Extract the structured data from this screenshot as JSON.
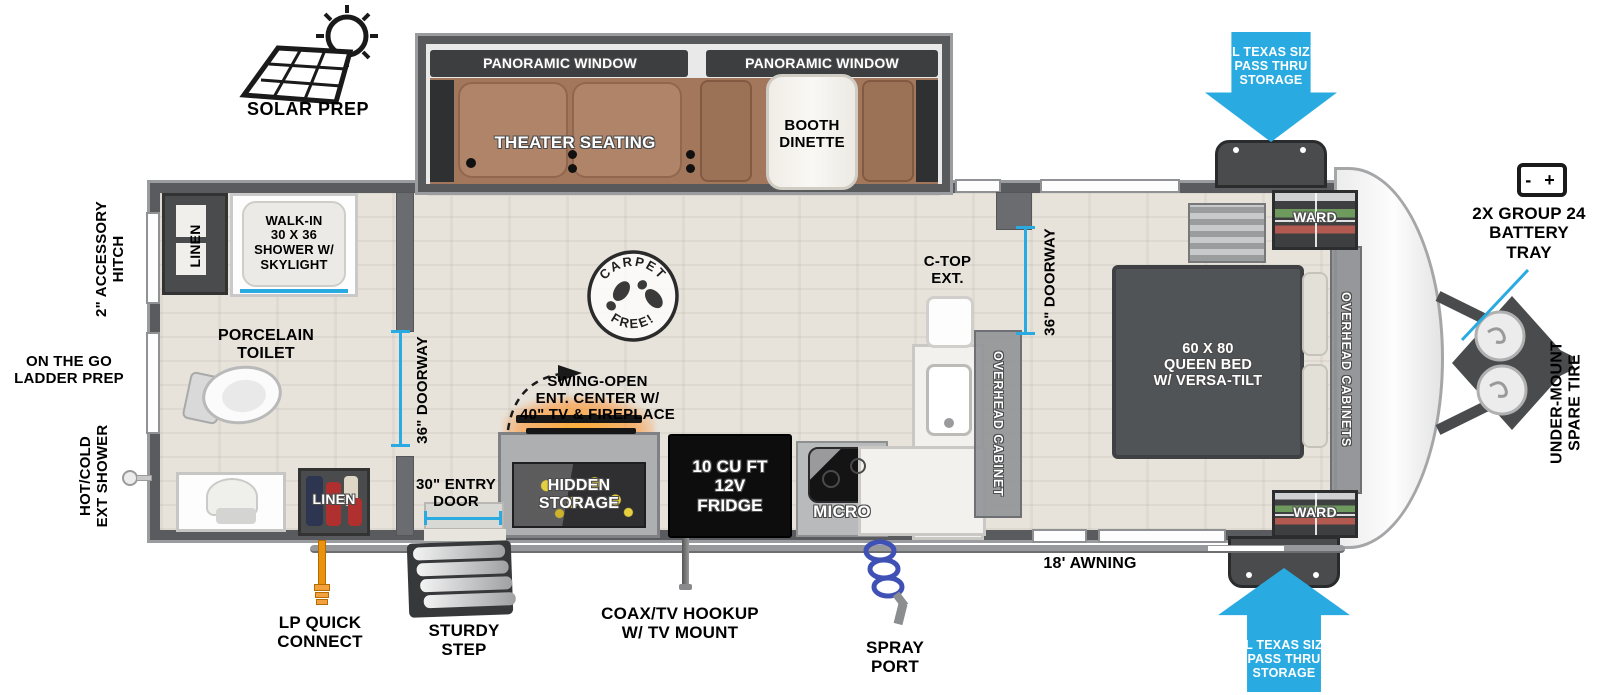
{
  "diagram": {
    "exterior": {
      "solar_prep": "SOLAR PREP",
      "pass_thru_storage_top": "XL TEXAS SIZE\nPASS THRU\nSTORAGE",
      "pass_thru_storage_bottom": "XL TEXAS SIZE\nPASS THRU\nSTORAGE",
      "battery_icon_text": "-  +",
      "battery_tray": "2X GROUP 24\nBATTERY\nTRAY",
      "under_mount_spare_tire": "UNDER-MOUNT\nSPARE TIRE",
      "accessory_hitch": "2\" ACCESSORY\nHITCH",
      "on_the_go_ladder_prep": "ON THE GO\nLADDER PREP",
      "hot_cold_ext_shower": "HOT/COLD\nEXT SHOWER",
      "lp_quick_connect": "LP QUICK\nCONNECT",
      "sturdy_step": "STURDY\nSTEP",
      "coax_tv_hookup": "COAX/TV HOOKUP\nW/ TV MOUNT",
      "spray_port": "SPRAY\nPORT",
      "awning": "18' AWNING"
    },
    "slideout": {
      "panoramic_window_left": "PANORAMIC WINDOW",
      "panoramic_window_right": "PANORAMIC WINDOW",
      "theater_seating": "THEATER SEATING",
      "booth_dinette": "BOOTH\nDINETTE"
    },
    "bathroom": {
      "linen_top": "LINEN",
      "walk_in_shower": "WALK-IN\n30 X 36\nSHOWER W/\nSKYLIGHT",
      "porcelain_toilet": "PORCELAIN\nTOILET",
      "doorway": "36\" DOORWAY",
      "linen_bottom": "LINEN"
    },
    "kitchen": {
      "swing_open_ent_center": "SWING-OPEN\nENT. CENTER W/\n40\" TV & FIREPLACE",
      "hidden_storage": "HIDDEN\nSTORAGE",
      "fridge": "10 CU FT\n12V\nFRIDGE",
      "micro": "MICRO",
      "c_top_ext": "C-TOP\nEXT.",
      "overhead_cabinet": "OVERHEAD CABINET",
      "doorway": "36\" DOORWAY",
      "entry_door": "30\" ENTRY\nDOOR"
    },
    "bedroom": {
      "queen_bed": "60 X 80\nQUEEN BED\nW/ VERSA-TILT",
      "ward_top": "WARD",
      "ward_bottom": "WARD",
      "overhead_cabinets": "OVERHEAD CABINETS"
    },
    "badge": {
      "carpet": "CARPET",
      "free": "FREE!"
    },
    "colors": {
      "arrow_blue": "#29abe2",
      "wall_gray": "#5a5b5e",
      "furniture_brown": "#a67a5e"
    }
  }
}
